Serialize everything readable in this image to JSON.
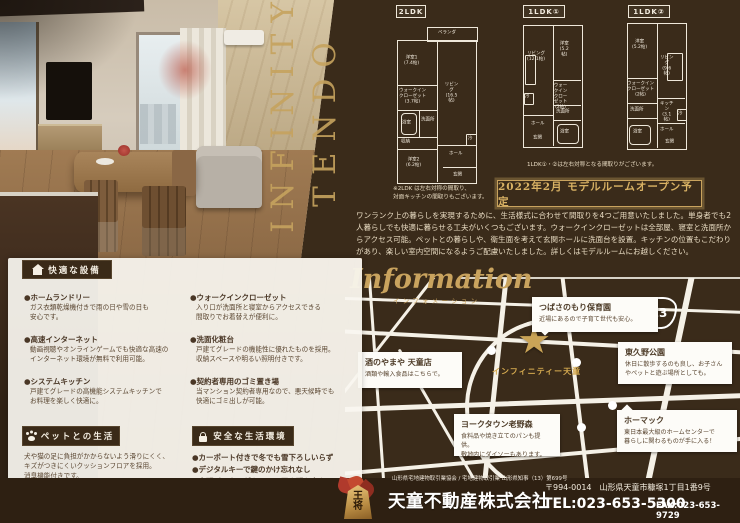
{
  "brand": {
    "line1": "INFINITY",
    "line2": "TENDO"
  },
  "plans": [
    {
      "title": "2LDK",
      "note": "※2LDK は左右対称の間取り、\n対面キッチンの間取りもございます。",
      "rooms": [
        "ベランダ",
        "洋室1\n(7.4帖)",
        "リビング\n(16.5帖)",
        "ウォークイン\nクローゼット\n(3.7帖)",
        "浴室",
        "洗面所",
        "収納",
        "洋室2\n(6.2帖)",
        "ホール",
        "玄関",
        "冷"
      ]
    },
    {
      "title": "1LDK①",
      "rooms": [
        "リビング\n(12.1帖)",
        "洋室\n(5.2帖)",
        "ウォークイン\nクローゼット\n(2帖)",
        "洗面所",
        "浴室",
        "ホール",
        "玄関",
        "冷"
      ]
    },
    {
      "title": "1LDK②",
      "rooms": [
        "洋室\n(5.2帖)",
        "リビング\n(9.6帖)",
        "ウォークイン\nクローゼット\n(2帖)",
        "洗面所",
        "キッチン\n(3.1帖)",
        "浴室",
        "ホール",
        "玄関",
        "冷"
      ]
    }
  ],
  "plans_note": "1LDK①・②は左右対称となる間取りがございます。",
  "banner": "2022年2月 モデルルームオープン予定",
  "intro": "ワンランク上の暮らしを実現するために、生活様式に合わせて間取りを4つご用意いたしました。単身者でも2人暮らしでも快適に暮らせる工夫がいくつもございます。ウォークインクローゼットは全部屋、寝室と洗面所からアクセス可能。ペットとの暮らしや、衛生面を考えて玄関ホールに洗面台を設置。キッチンの位置もこだわりがあり、楽しい室内空間になるようご配慮いたしました。詳しくはモデルルームにお越しください。",
  "information": {
    "title": "Information",
    "subtitle": "インフォメーション"
  },
  "map": {
    "route_number": "13",
    "property_label": "インフィニティー天童",
    "pois": [
      {
        "name": "つばさのもり保育園",
        "desc": "近場にあるので子育て世代も安心。"
      },
      {
        "name": "酒のやまや 天童店",
        "desc": "酒類や輸入食品はこちらで。"
      },
      {
        "name": "東久野公園",
        "desc": "休日に散歩するのも良し、お子さん\nやペットと遊ぶ場所としても。"
      },
      {
        "name": "ヨークタウン老野森",
        "desc": "食料品や焼き立てのパンも提供。\n敷地内にダイソーもあります。"
      },
      {
        "name": "ホーマック",
        "desc": "東日本最大級のホームセンターで\n暮らしに関わるものが手に入る！"
      }
    ]
  },
  "features": {
    "comfort": {
      "title": "快適な設備",
      "items": [
        {
          "t": "●ホームランドリー",
          "d": "ガス衣類乾燥機付きで雨の日や雪の日も\n安心です。"
        },
        {
          "t": "●高速インターネット",
          "d": "動画視聴やオンラインゲームでも快適な高速の\nインターネット環境が無料で利用可能。"
        },
        {
          "t": "●システムキッチン",
          "d": "戸建てグレードの高機能システムキッチンで\nお料理を楽しく快適に。"
        },
        {
          "t": "●ウォークインクローゼット",
          "d": "入り口が洗面所と寝室からアクセスできる\n間取りでお着替えが便利に。"
        },
        {
          "t": "●洗面化粧台",
          "d": "戸建てグレードの機能性に優れたものを採用。\n収納スペースや明るい照明付きです。"
        },
        {
          "t": "●契約者専用のゴミ置き場",
          "d": "当マンション契約者専用なので、悪天候時でも\n快適にゴミ出しが可能。"
        }
      ]
    },
    "pet": {
      "title": "ペットとの生活",
      "desc": "犬や猫の足に負担がかからないよう滑りにくく、\nキズがつきにくいクッションフロアを採用。\n消臭機能付きです。"
    },
    "safety": {
      "title": "安全な生活環境",
      "items": [
        "●カーポート付きで冬でも雪下ろしいらず",
        "●デジタルキーで鍵のかけ忘れなし",
        "●宅配ボックスがあるので置き配も安心"
      ]
    }
  },
  "footer": {
    "license": "山形県宅地建物取引業協会 / 宅地建物取引業 山形県知事（13）第699号",
    "company": "天童不動産株式会社",
    "postal": "〒994-0014　山形県天童市糠塚1丁目1番9号",
    "tel": "TEL:023-653-5300",
    "fax": "FAX:023-653-9729",
    "logo_text": "王\n将"
  },
  "colors": {
    "background": "#3a2b1a",
    "gold": "#c9a35e",
    "panel": "#f7f4ee"
  }
}
